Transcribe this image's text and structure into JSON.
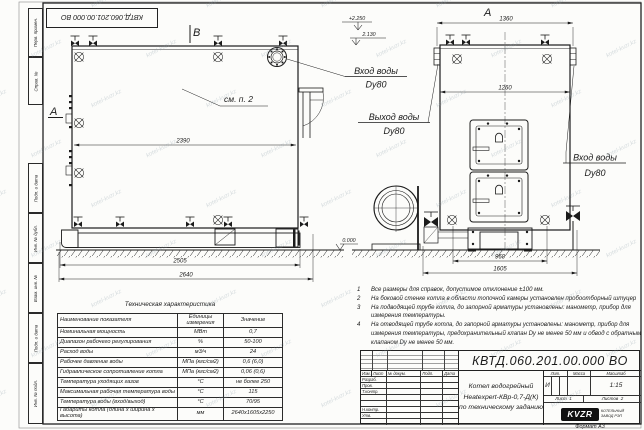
{
  "watermark": "kotel-kvzr.kz",
  "frame": {
    "top_stamp": "КВТД.060.201.00.000  ВО",
    "format_note": "Формат  А3",
    "margin_labels": [
      "Перв. примен.",
      "Справ. №",
      "Подп. и дата",
      "Инв. № дубл.",
      "Взам. инв. №",
      "Подп. и дата",
      "Инв. № подл."
    ]
  },
  "drawing": {
    "marker_b": "B",
    "marker_a_side": "A",
    "marker_a_front": "A",
    "see_note": "см. п. 2",
    "labels": {
      "inlet_top": {
        "line1": "Вход воды",
        "line2": "Dy80"
      },
      "outlet": {
        "line1": "Выход воды",
        "line2": "Dy80"
      },
      "inlet_right": {
        "line1": "Вход воды",
        "line2": "Dy80"
      }
    },
    "elevations": {
      "top": "+2.250",
      "mid": "2.130",
      "zero": "0.000"
    },
    "dimensions": {
      "body_length": "2390",
      "skid_length": "2505",
      "overall_length": "2640",
      "front_overall_width": "1360",
      "front_body_width": "1260",
      "base_width": "960",
      "overall_width": "1605"
    }
  },
  "notes": [
    {
      "num": "1",
      "text": "Все размеры для справок, допустимое отклонение ±100 мм."
    },
    {
      "num": "2",
      "text": "На боковой стенке котла в области топочной камеры установлен пробоотборный штуцер"
    },
    {
      "num": "3",
      "text": "На подводящей трубе котла, до запорной арматуры установлены: манометр, прибор для измерения температуры."
    },
    {
      "num": "4",
      "text": "На отводящей трубе котла, до запорной арматуры установлены: манометр, прибор для измерения температуры, предохранительный клапан Dу не менее 50 мм и обвод с обратным клапаном Dу не менее 50 мм."
    }
  ],
  "tech_table": {
    "title": "Техническая характеристика",
    "headers": {
      "name": "Наименование показателя",
      "units": "Единицы измерения",
      "value": "Значение"
    },
    "rows": [
      {
        "name": "Номинальная мощность",
        "units": "МВт",
        "value": "0,7"
      },
      {
        "name": "Диапазон рабочего регулирования",
        "units": "%",
        "value": "50-100"
      },
      {
        "name": "Расход воды",
        "units": "м3/ч",
        "value": "24"
      },
      {
        "name": "Рабочее давление воды",
        "units": "МПа (кгс/см2)",
        "value": "0,6 (6,0)"
      },
      {
        "name": "Гидравлическое сопротивление котла",
        "units": "МПа (кгс/см2)",
        "value": "0,06 (0,6)"
      },
      {
        "name": "Температура уходящих газов",
        "units": "°С",
        "value": "не более 250"
      },
      {
        "name": "Максимальная рабочая температура воды",
        "units": "°С",
        "value": "115"
      },
      {
        "name": "Температура воды (вход/выход)",
        "units": "°С",
        "value": "70/95"
      },
      {
        "name": "Габариты котла (длина х ширина х высота)",
        "units": "мм",
        "value": "2640х1605х2250"
      }
    ]
  },
  "title_block": {
    "doc_number": "КВТД.060.201.00.000  ВО",
    "product_name_lines": [
      "Котел водогрейный",
      "Heatexpert-КВр-0,7-Д(К)",
      "по техническому заданию"
    ],
    "rev_headers": [
      "Изм.",
      "Лист",
      "№ докум.",
      "Подп.",
      "Дата"
    ],
    "role_labels": [
      "Разраб.",
      "Пров.",
      "Т.контр.",
      "",
      "",
      "Н.контр.",
      "Утв.",
      ""
    ],
    "lit_header": "Лит.",
    "mass_header": "Масса",
    "scale_header": "Масштаб",
    "lit_value": "И",
    "scale_value": "1:15",
    "sheet_label": "Лист",
    "sheet_value": "1",
    "sheets_label": "Листов",
    "sheets_value": "2",
    "logo_text": "KVZR",
    "logo_caption_line1": "КОТЕЛЬНЫЙ",
    "logo_caption_line2": "ЗАВОД РЭП"
  }
}
